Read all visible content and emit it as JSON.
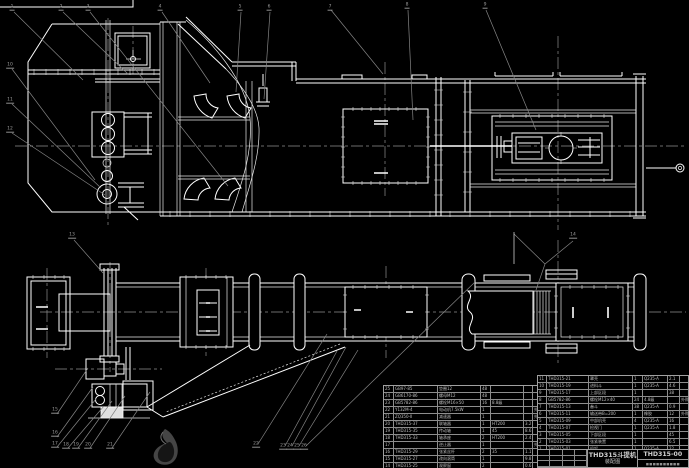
{
  "drawing": {
    "title": "THD315斗提机",
    "subtitle": "装配图",
    "drawing_number": "THD315-00",
    "org_line": "■■■■■■■■■■"
  },
  "bom_right": {
    "headers": [
      "序号",
      "代 号",
      "名  称",
      "数量",
      "材 料",
      "重量",
      "备注"
    ],
    "rows": [
      [
        "11",
        "THD315-21",
        "罩壳",
        "1",
        "Q235-A",
        "2.1",
        ""
      ],
      [
        "10",
        "THD315-19",
        "进料斗",
        "1",
        "Q235-A",
        "4.6",
        ""
      ],
      [
        "9",
        "THD315-17",
        "上部区段",
        "1",
        "",
        "38",
        ""
      ],
      [
        "8",
        "GB5782-86",
        "螺栓M12×40",
        "24",
        "4.8级",
        "",
        "外购"
      ],
      [
        "7",
        "THD315-13",
        "畚斗",
        "38",
        "Q235-A",
        "0.9",
        ""
      ],
      [
        "6",
        "THD315-11",
        "输送带B=200",
        "1",
        "橡胶",
        "12",
        "外购"
      ],
      [
        "5",
        "THD315-09",
        "中部机壳",
        "4",
        "Q235-A",
        "16",
        ""
      ],
      [
        "4",
        "THD315-07",
        "检视门",
        "1",
        "Q235-A",
        "1.8",
        ""
      ],
      [
        "3",
        "THD315-05",
        "下部区段",
        "1",
        "",
        "45",
        ""
      ],
      [
        "2",
        "THD315-03",
        "张紧装置",
        "1",
        "",
        "6.5",
        ""
      ],
      [
        "1",
        "THD315-01",
        "机架",
        "1",
        "Q235-A",
        "22",
        ""
      ]
    ]
  },
  "bom_left": {
    "rows": [
      [
        "25",
        "GB97-85",
        "垫圈12",
        "48",
        "",
        "",
        ""
      ],
      [
        "24",
        "GB6170-86",
        "螺母M12",
        "48",
        "",
        "",
        ""
      ],
      [
        "23",
        "GB5782-86",
        "螺栓M16×50",
        "16",
        "8.8级",
        "",
        ""
      ],
      [
        "22",
        "Y132M-4",
        "电动机7.5kW",
        "1",
        "",
        "",
        "外购"
      ],
      [
        "21",
        "ZQ350-Ⅱ",
        "减速器",
        "1",
        "",
        "",
        "外购"
      ],
      [
        "20",
        "THD315-37",
        "联轴器",
        "1",
        "HT200",
        "3.2",
        ""
      ],
      [
        "19",
        "THD315-35",
        "传动轴",
        "1",
        "45",
        "8.6",
        ""
      ],
      [
        "18",
        "THD315-33",
        "轴承座",
        "2",
        "HT200",
        "2.4",
        ""
      ],
      [
        "17",
        "",
        "逆止器",
        "1",
        "",
        "",
        "外购"
      ],
      [
        "16",
        "THD315-29",
        "张紧丝杆",
        "2",
        "35",
        "1.1",
        ""
      ],
      [
        "15",
        "THD315-27",
        "改向滚筒",
        "1",
        "",
        "9.8",
        ""
      ],
      [
        "14",
        "THD315-25",
        "观察窗",
        "2",
        "",
        "0.6",
        ""
      ],
      [
        "13",
        "THD315-23",
        "卸料口",
        "1",
        "Q235-A",
        "2.2",
        ""
      ],
      [
        "12",
        "THD315-22",
        "护罩",
        "1",
        "Q235-A",
        "1.9",
        ""
      ]
    ]
  },
  "balloons": [
    {
      "label": "1",
      "x": 12,
      "y": 8
    },
    {
      "label": "2",
      "x": 61,
      "y": 8
    },
    {
      "label": "3",
      "x": 88,
      "y": 8
    },
    {
      "label": "4",
      "x": 160,
      "y": 8
    },
    {
      "label": "5",
      "x": 240,
      "y": 8
    },
    {
      "label": "6",
      "x": 269,
      "y": 8
    },
    {
      "label": "7",
      "x": 330,
      "y": 8
    },
    {
      "label": "8",
      "x": 407,
      "y": 6
    },
    {
      "label": "9",
      "x": 485,
      "y": 6
    },
    {
      "label": "10",
      "x": 10,
      "y": 66
    },
    {
      "label": "11",
      "x": 10,
      "y": 101
    },
    {
      "label": "12",
      "x": 10,
      "y": 130
    },
    {
      "label": "13",
      "x": 72,
      "y": 236
    },
    {
      "label": "14",
      "x": 573,
      "y": 236
    },
    {
      "label": "15",
      "x": 55,
      "y": 411
    },
    {
      "label": "16",
      "x": 55,
      "y": 434
    },
    {
      "label": "17",
      "x": 55,
      "y": 445
    },
    {
      "label": "18",
      "x": 66,
      "y": 446
    },
    {
      "label": "19",
      "x": 76,
      "y": 446
    },
    {
      "label": "20",
      "x": 88,
      "y": 446
    },
    {
      "label": "21",
      "x": 110,
      "y": 446
    },
    {
      "label": "22",
      "x": 256,
      "y": 445
    },
    {
      "label": "23",
      "x": 283,
      "y": 447
    },
    {
      "label": "24",
      "x": 290,
      "y": 447
    },
    {
      "label": "25",
      "x": 297,
      "y": 447
    },
    {
      "label": "26",
      "x": 304,
      "y": 447
    }
  ],
  "colors": {
    "background": "#000000",
    "linework": "#ffffff",
    "leaders": "#858585",
    "table_text": "#bdbdbd"
  }
}
